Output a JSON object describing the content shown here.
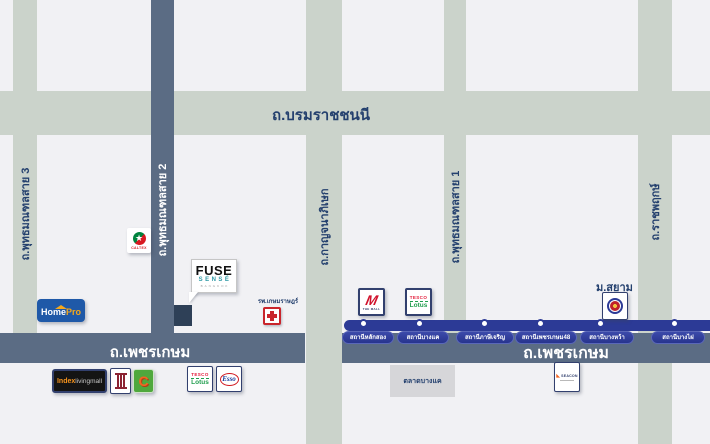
{
  "colors": {
    "background": "#f1f1f4",
    "road_light": "#cbd3cb",
    "road_dark": "#5b6c84",
    "mrt_blue": "#2c3a96",
    "navy_text": "#24406e"
  },
  "roads": {
    "borommaratchachonnani": {
      "label": "ถ.บรมราชชนนี"
    },
    "phutthamonthon_sai_3": {
      "label": "ถ.พุทธมณฑลสาย 3"
    },
    "phutthamonthon_sai_2": {
      "label": "ถ.พุทธมณฑลสาย 2"
    },
    "kanchanaphisek": {
      "label": "ถ.กาญจนาภิเษก"
    },
    "phutthamonthon_sai_1": {
      "label": "ถ.พุทธมณฑลสาย 1"
    },
    "ratchaphruek": {
      "label": "ถ.ราชพฤกษ์"
    },
    "phetkasem_west": {
      "label": "ถ.เพชรเกษม"
    },
    "phetkasem_east": {
      "label": "ถ.เพชรเกษม"
    }
  },
  "mrt": {
    "stations": [
      {
        "label": "สถานีหลักสอง"
      },
      {
        "label": "สถานีบางแค"
      },
      {
        "label": "สถานีภาษีเจริญ"
      },
      {
        "label": "สถานีเพชรเกษม48"
      },
      {
        "label": "สถานีบางหว้า"
      },
      {
        "label": "สถานีบางไผ่"
      }
    ]
  },
  "landmarks": {
    "caltex": {
      "label": "CALTEX",
      "star": "★"
    },
    "homepro": {
      "home": "Home",
      "pro": "Pro"
    },
    "fuse_sense": {
      "name": "FUSE",
      "sub": "SENSÉ",
      "city": "BANGKOK"
    },
    "kasemrad_hospital": {
      "label": "รพ.เกษมราษฎร์"
    },
    "index_living_mall": {
      "index": "Index",
      "livingmall": "livingmall"
    },
    "big_c": {
      "label": "C"
    },
    "tesco_lotus_west": {
      "tesco": "TESCO",
      "lotus": "Lotus"
    },
    "esso": {
      "label": "Esso"
    },
    "the_mall": {
      "m": "M",
      "label": "THE MALL"
    },
    "tesco_lotus_east": {
      "tesco": "TESCO",
      "lotus": "Lotus"
    },
    "siam_university": {
      "label": "ม.สยาม"
    },
    "bang_khae_market": {
      "label": "ตลาดบางแค"
    },
    "seacon": {
      "label": "SEACON",
      "mark": "◣"
    }
  }
}
